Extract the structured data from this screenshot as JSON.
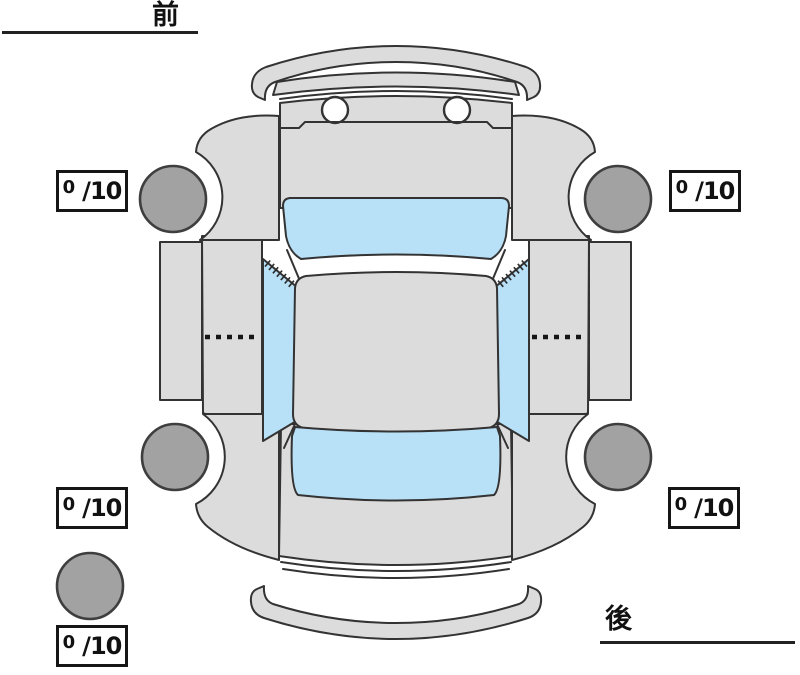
{
  "orientation": {
    "front_label": "前",
    "rear_label": "後"
  },
  "tire_tread_scores": {
    "suffix": "/10",
    "front_left": "0",
    "front_right": "0",
    "rear_left": "0",
    "rear_right": "0",
    "spare": "0"
  },
  "colors": {
    "body": "#dcdcdc",
    "glass": "#b8e0f6",
    "tire": "#a2a2a2",
    "outline": "#333333",
    "background": "#ffffff",
    "text": "#111111"
  }
}
